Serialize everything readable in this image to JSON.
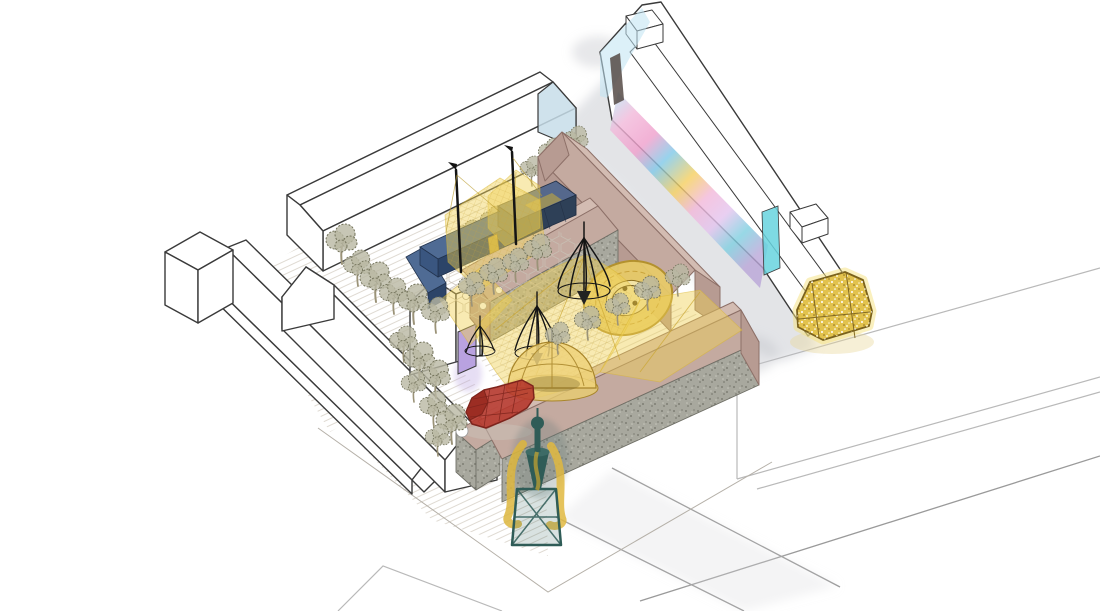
{
  "meta": {
    "title": "Axonometric courtyard masterplan illustration",
    "canvas": {
      "width": 1100,
      "height": 611
    },
    "style": "hand-drawn architectural axonometric with watercolor washes",
    "visible_text": []
  },
  "palette": {
    "outline": "#3a3a3a",
    "faint-outline": "#b9b9b9",
    "grey-wash": "#b8bcc4",
    "hatch": "#dcd6cd",
    "hex-paving": "#c8c0b4",
    "brown-wall": "#b79b92",
    "brown-roof": "#c4aaa0",
    "brown-roof-dark": "#8d7068",
    "stone": "#a8a89e",
    "tree-foliage": "#b9b8a2",
    "tree-stroke": "#72725a",
    "trunk": "#9b9378",
    "canopy-yellow": "#f0d155",
    "canopy-line": "#d9b52e",
    "gold": "#e2c24d",
    "gold-dark": "#7a611c",
    "mosaic-gold": "#e7cb67",
    "mosaic-rim": "#b3912e",
    "bench-blue": "#4f6b94",
    "bench-blue-dark": "#2c4468",
    "container-navy": "#3a4f6e",
    "container-top": "#55688c",
    "red-structure": "#b5372c",
    "red-dark": "#7e241c",
    "teal": "#2f5c57",
    "purple-door": "#b9a2e0",
    "mural-pink": "#f2b7d9",
    "mural-blue": "#7ec8e8",
    "mural-yellow": "#f5cf5e",
    "mural-cyan": "#67d4de",
    "gable-blue": "#c7dde9",
    "black-frame": "#141414"
  },
  "scene": {
    "type": "architectural-axonometric-illustration",
    "elements": [
      {
        "name": "street-network",
        "desc": "faint grey street edges and pavement outlines at bottom right and bottom left"
      },
      {
        "name": "outline-block-bottom-right",
        "desc": "unshaded neighbouring building drawn in faint grey outline"
      },
      {
        "name": "grey-path-wash",
        "desc": "grey watercolor wash lane between courtyard buildings and mural building",
        "color": "#b8bcc4"
      },
      {
        "name": "left-terrace-buildings",
        "desc": "two long white outline pitched-roof terraces with a corner tower block"
      },
      {
        "name": "north-hall-building",
        "desc": "long white outline hall, light-blue shaded gable at its north-east end",
        "color": "#c7dde9"
      },
      {
        "name": "purple-door-house",
        "desc": "small white gabled house with purple doorway opening to courtyard",
        "color": "#b9a2e0"
      },
      {
        "name": "mural-gallery-building",
        "desc": "long flat-roofed building, south-west wall painted with pink-blue-yellow mural, cyan glass ends, two rooftop cabins"
      },
      {
        "name": "brown-warehouse-complex",
        "desc": "T-shaped warehouse, rosy-brown render with pitched roofs",
        "color": "#b79b92"
      },
      {
        "name": "long-warehouse",
        "desc": "long warehouse bar with grey stone/gabion base wall and brown roof, small annex house at its west end",
        "color": "#a8a89e"
      },
      {
        "name": "courtyard-hatch-paving",
        "desc": "diagonally hatched courtyard ground plane"
      },
      {
        "name": "hexagonal-paving",
        "desc": "honeycomb paving patch around the seating corner"
      },
      {
        "name": "blue-l-bench",
        "desc": "L-shaped navy seating bench",
        "color": "#4f6b94"
      },
      {
        "name": "navy-container-stage",
        "desc": "dark blue shipping-container kiosk with yellow tent wrap",
        "color": "#3a4f6e"
      },
      {
        "name": "canopy-masts",
        "desc": "black masts with pennants holding the yellow nets"
      },
      {
        "name": "yellow-canopy-nets",
        "desc": "translucent yellow net canopies draped across the courtyard",
        "color": "#f0d155"
      },
      {
        "name": "tree-umbrella-frames",
        "desc": "black wire umbrella/broom frames over planting rings"
      },
      {
        "name": "mosaic-circle",
        "desc": "circular golden mosaic ground inlay with ornate dark centre",
        "color": "#e7cb67"
      },
      {
        "name": "lattice-dome-pavilion",
        "desc": "golden lattice dome pavilion",
        "color": "#eed27a"
      },
      {
        "name": "red-lattice-tunnel",
        "desc": "red wireframe growing-tunnel / polytunnel",
        "color": "#b5372c"
      },
      {
        "name": "teal-tower-sculpture",
        "desc": "dark teal tower sculpture with trestle base and yellow spiral elements",
        "color": "#2f5c57"
      },
      {
        "name": "golden-kiosk",
        "desc": "glittering golden hexagonal kiosk at the street corner",
        "color": "#e2c24d"
      },
      {
        "name": "street-trees",
        "desc": "rows of scribbled olive-grey trees lining the courtyard edges"
      },
      {
        "name": "rooftop-cabins",
        "desc": "two small white rooftop boxes on the mural building"
      },
      {
        "name": "mural-wall",
        "desc": "watercolor mural in pink, blue and yellow along the lane wall"
      },
      {
        "name": "cyan-glass-end",
        "desc": "cyan glazed end wall of the mural building",
        "color": "#67d4de"
      }
    ]
  }
}
